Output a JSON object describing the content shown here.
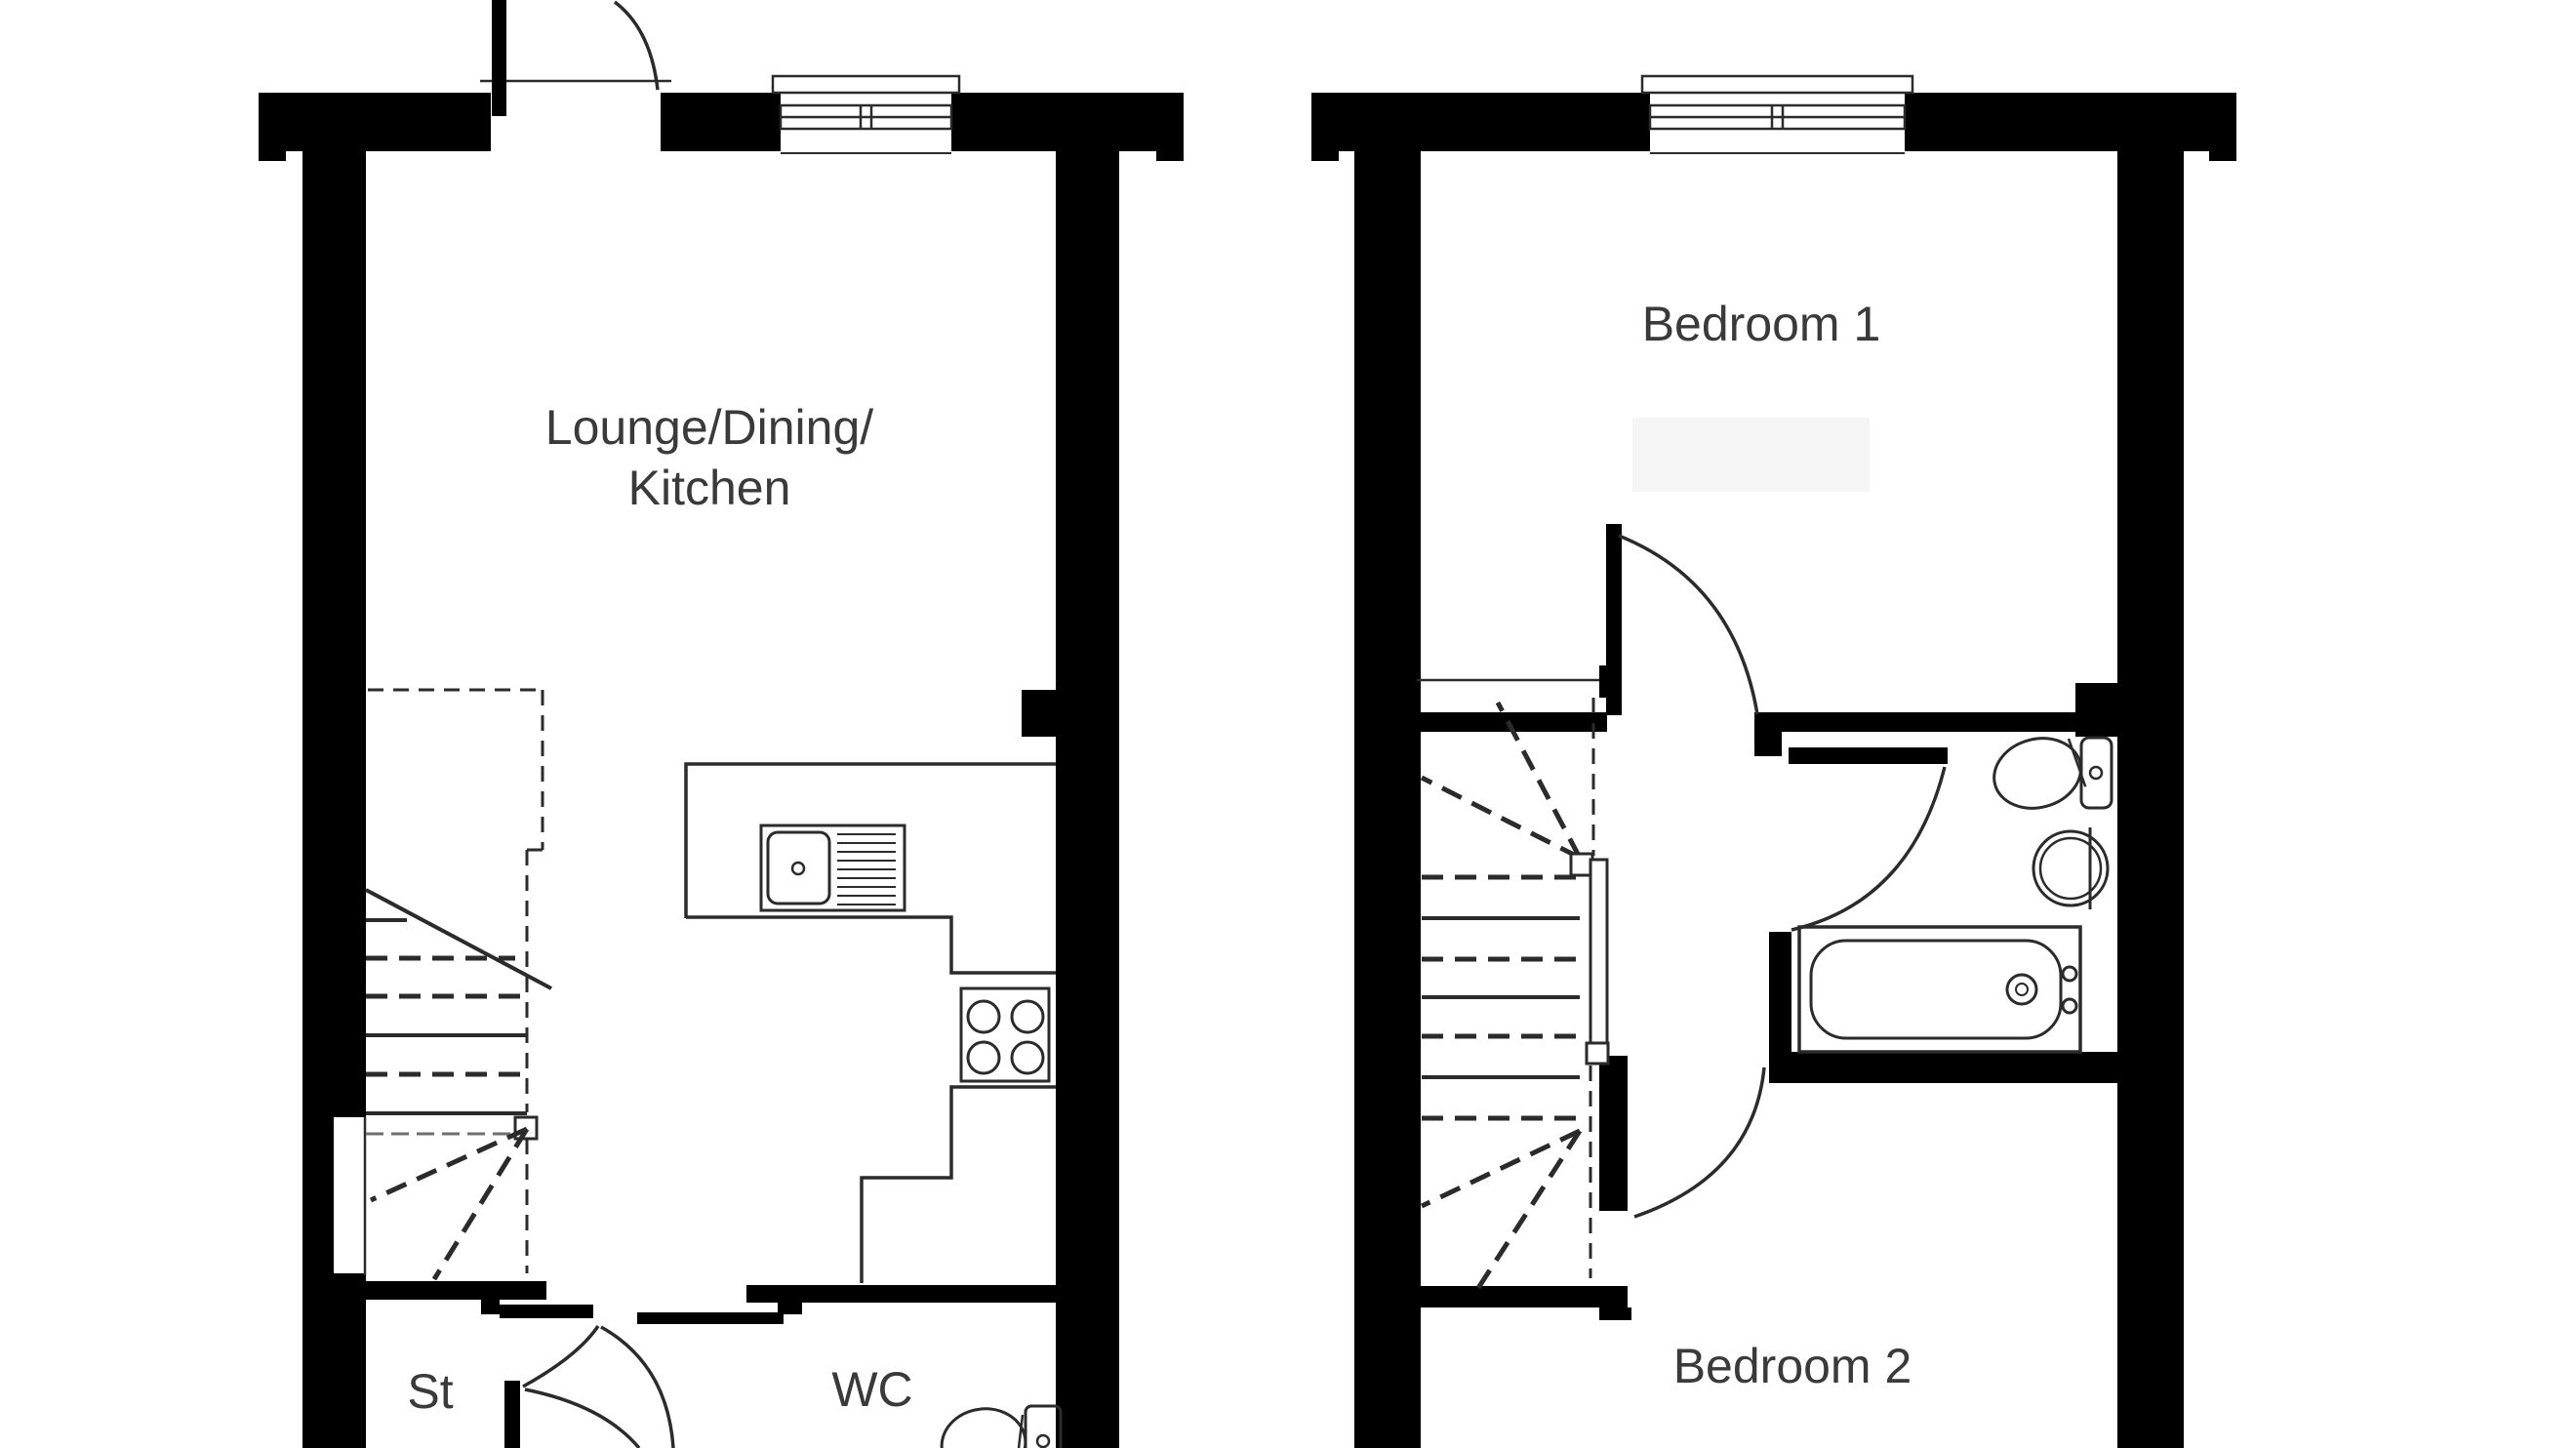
{
  "page": {
    "type": "floorplan-drawing",
    "background": "#ffffff"
  },
  "colors": {
    "wall": "#000000",
    "line": "#2b2b2b",
    "label": "#3a3a3a",
    "faint_box": "#f5f5f5"
  },
  "labels": {
    "lounge_line1": "Lounge/Dining/",
    "lounge_line2": "Kitchen",
    "storage": "St",
    "wc": "WC",
    "bedroom1": "Bedroom 1",
    "bedroom2": "Bedroom 2"
  },
  "fixtures": {
    "ground_floor": [
      "front-door",
      "window",
      "staircase",
      "kitchen-counter",
      "kitchen-sink",
      "hob",
      "st-door",
      "wc-door",
      "wc-toilet"
    ],
    "first_floor": [
      "window",
      "staircase",
      "handrail",
      "bedroom1-door",
      "bathroom-door",
      "bedroom2-door",
      "toilet",
      "basin",
      "bath"
    ]
  }
}
